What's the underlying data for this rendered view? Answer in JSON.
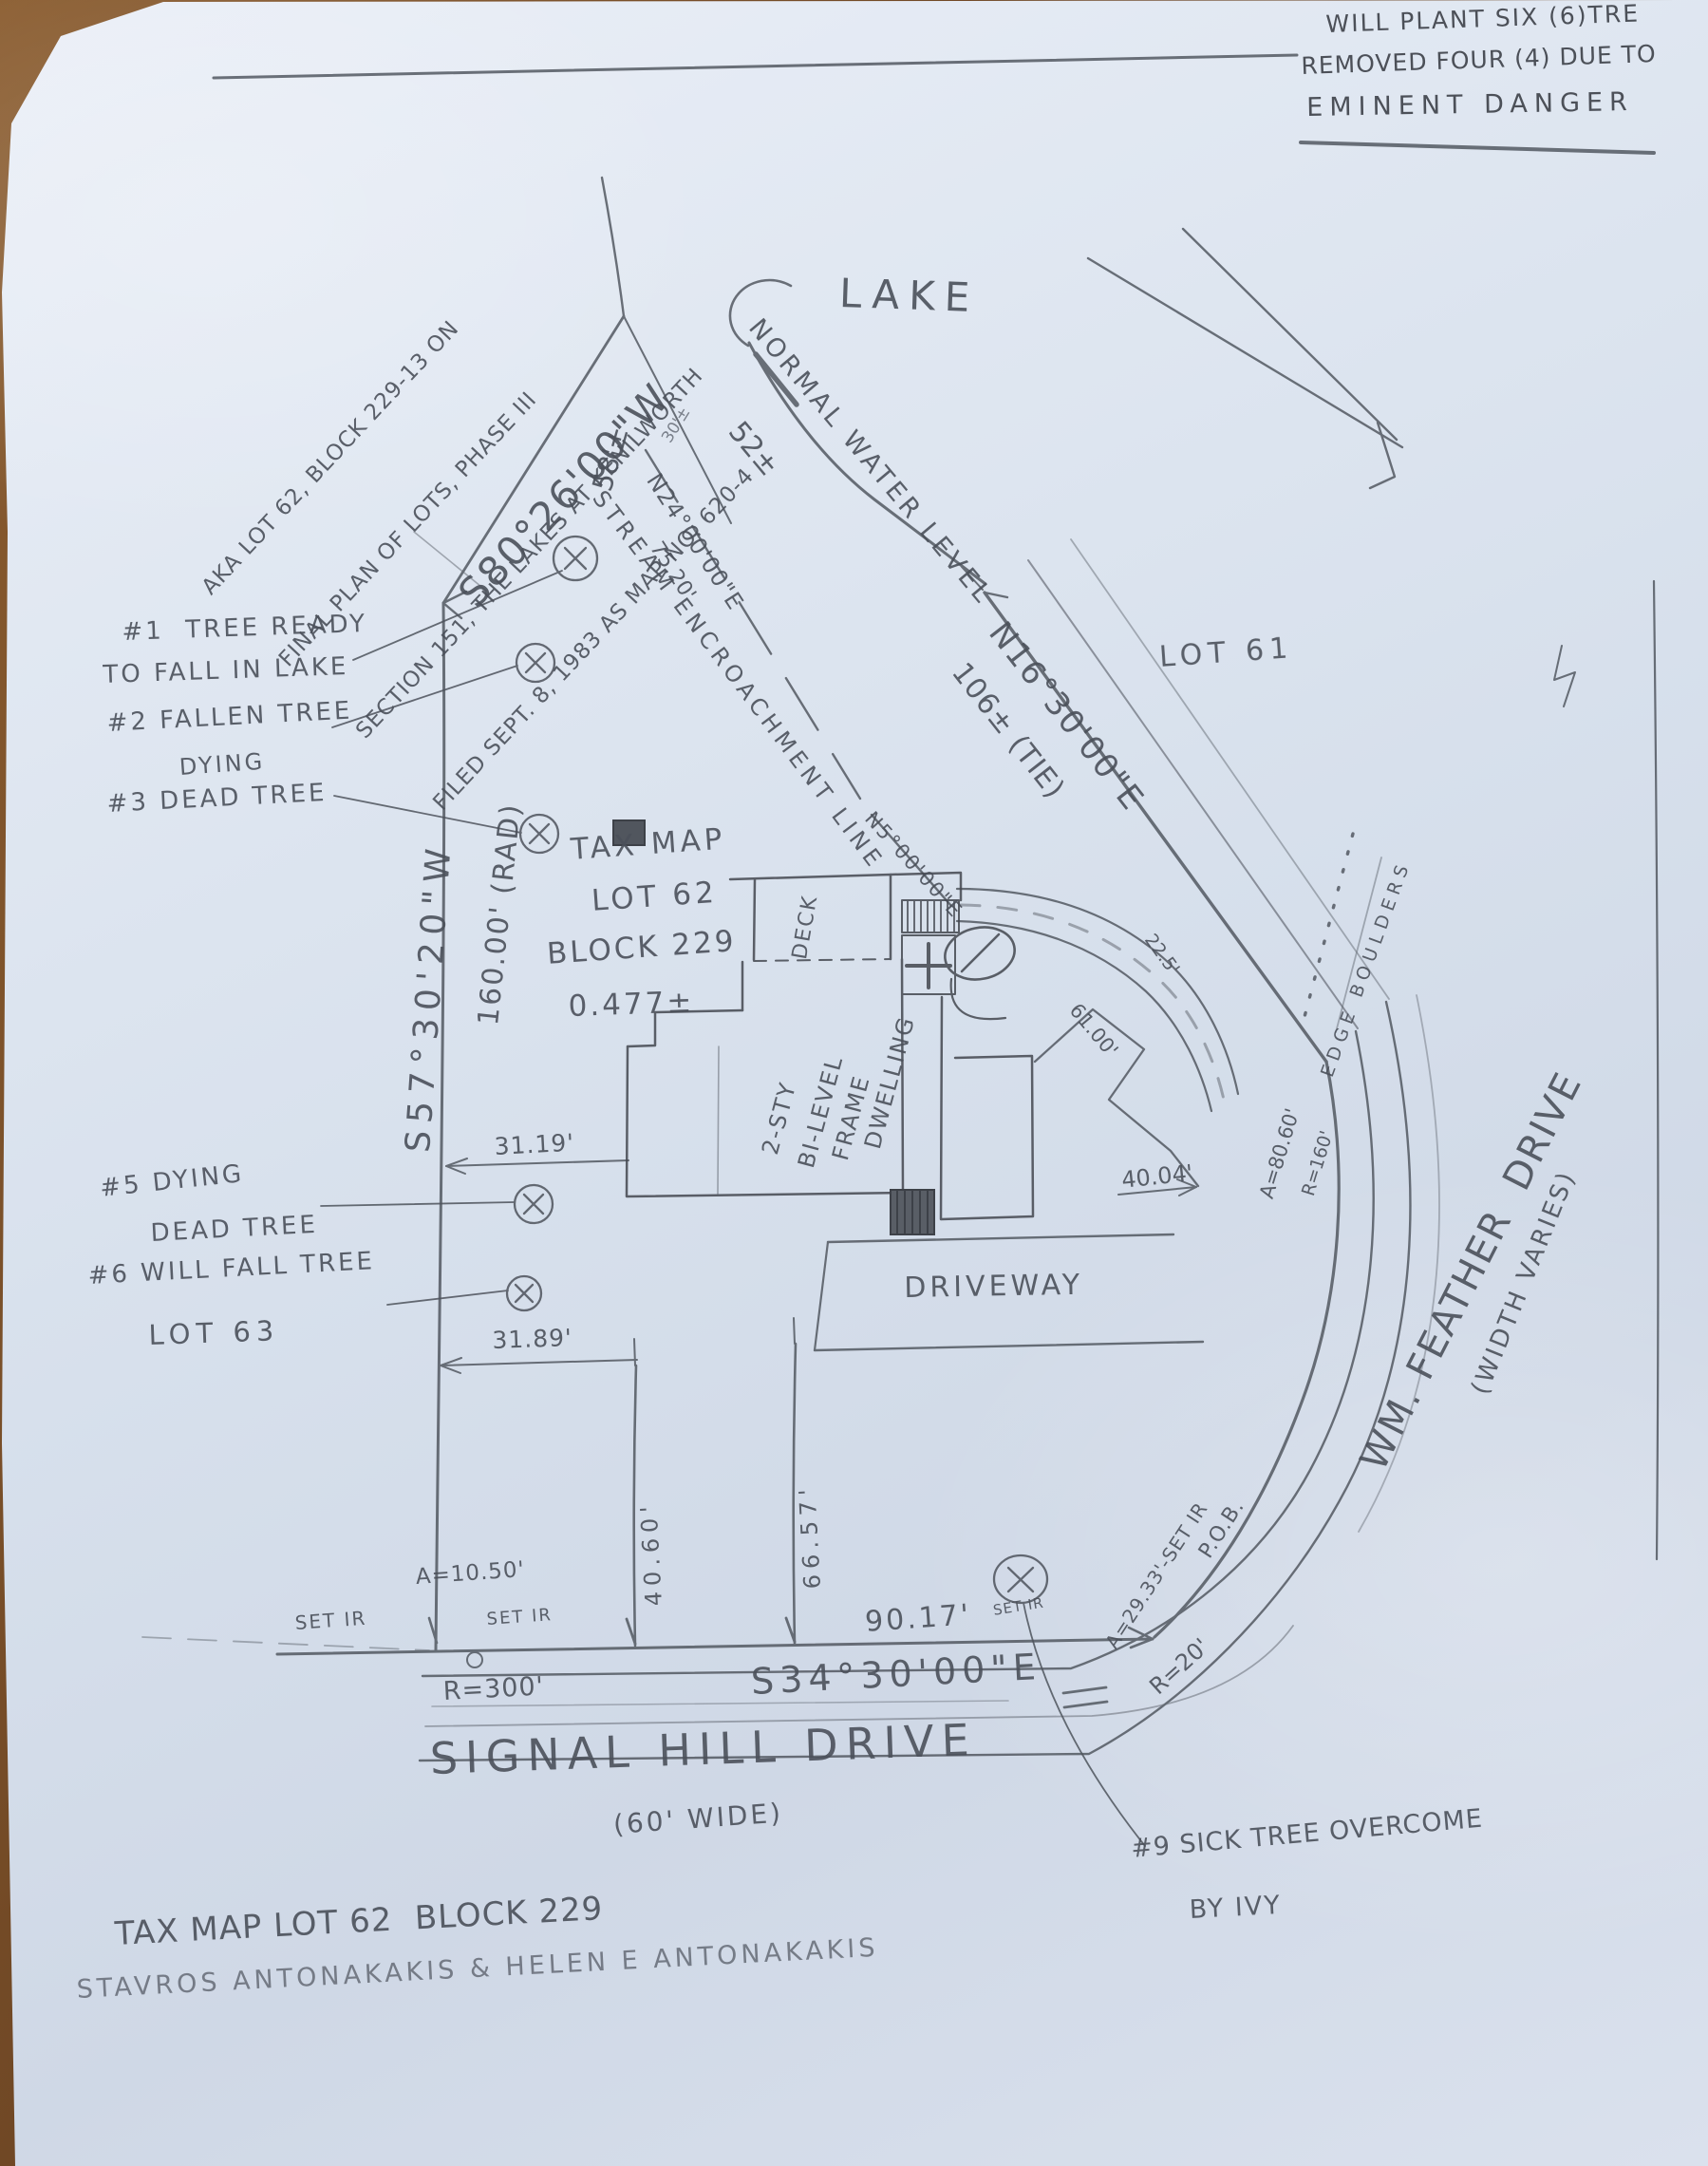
{
  "notes": {
    "top_right_1": "WILL PLANT SIX (6)TRE",
    "top_right_2": "REMOVED FOUR (4) DUE TO",
    "top_right_3": "EMINENT DANGER",
    "plan_ref_1": "AKA LOT 62, BLOCK 229-13 ON",
    "plan_ref_2": "FINAL PLAN OF LOTS, PHASE III",
    "plan_ref_3": "SECTION 151, THE LAKES AT KENILWORTH",
    "plan_ref_4": "FILED SEPT. 8, 1983 AS MAP NO. 620-4",
    "tree1_line1": "#1  TREE READY",
    "tree1_line2": "TO FALL IN LAKE",
    "tree2": "#2 FALLEN TREE",
    "tree3_line1": "DYING",
    "tree3_line2": "#3 DEAD TREE",
    "tree5_line1": "#5 DYING",
    "tree5_line2": "DEAD TREE",
    "tree6": "#6 WILL FALL TREE",
    "tree9_line1": "#9 SICK TREE OVERCOME",
    "tree9_line2": "BY IVY"
  },
  "water": {
    "lake": "LAKE",
    "normal_water_level": "NORMAL WATER LEVEL",
    "level": "52±"
  },
  "bearings": {
    "s80": "S80°26'00\"W",
    "s57": "S57°30'20\"W",
    "n24": "N24°00'00\"E",
    "n24_dist": "75.20'",
    "n16": "N16°30'00\"E",
    "n16_dist": "106± (TIE)",
    "s34": "S34°30'00\"E",
    "n5": "N5°00'00\"E"
  },
  "dimensions": {
    "d58": "58'±",
    "d30": "30'±",
    "rad": "160.00' (RAD)",
    "d3119": "31.19'",
    "d3189": "31.89'",
    "d4060": "40.60'",
    "d6657": "66.57'",
    "d9017": "90.17'",
    "d4004": "40.04'",
    "d6100": "61.00'",
    "d225": "22.5'",
    "a1050": "A=10.50'",
    "r300": "R=300'",
    "a2933": "A=29.33'-SET IR",
    "r20": "R=20'",
    "a8060": "A=80.60'",
    "r160": "R=160'"
  },
  "features": {
    "stream": "STREAM ENCROACHMENT LINE",
    "edge_boulders": "EDGE BOULDERS",
    "deck": "DECK",
    "driveway": "DRIVEWAY",
    "dwelling_1": "2-STY",
    "dwelling_2": "BI-LEVEL",
    "dwelling_3": "FRAME",
    "dwelling_4": "DWELLING"
  },
  "parcels": {
    "lot61": "LOT 61",
    "lot63": "LOT 63",
    "subject_1": "TAX MAP",
    "subject_2": "LOT 62",
    "subject_3": "BLOCK 229",
    "subject_4": "0.477±"
  },
  "roads": {
    "signal_hill": "SIGNAL HILL DRIVE",
    "signal_hill_width": "(60' WIDE)",
    "wm_feather": "WM. FEATHER  DRIVE",
    "wm_feather_width": "(WIDTH VARIES)"
  },
  "markers": {
    "set_ir_left": "SET IR",
    "set_ir_mid": "SET IR",
    "set_ir_right": "SET IR",
    "pob": "P.O.B."
  },
  "footer": {
    "title": "TAX MAP LOT 62  BLOCK 229",
    "owners": "STAVROS ANTONAKAKIS & HELEN E ANTONAKAKIS"
  }
}
